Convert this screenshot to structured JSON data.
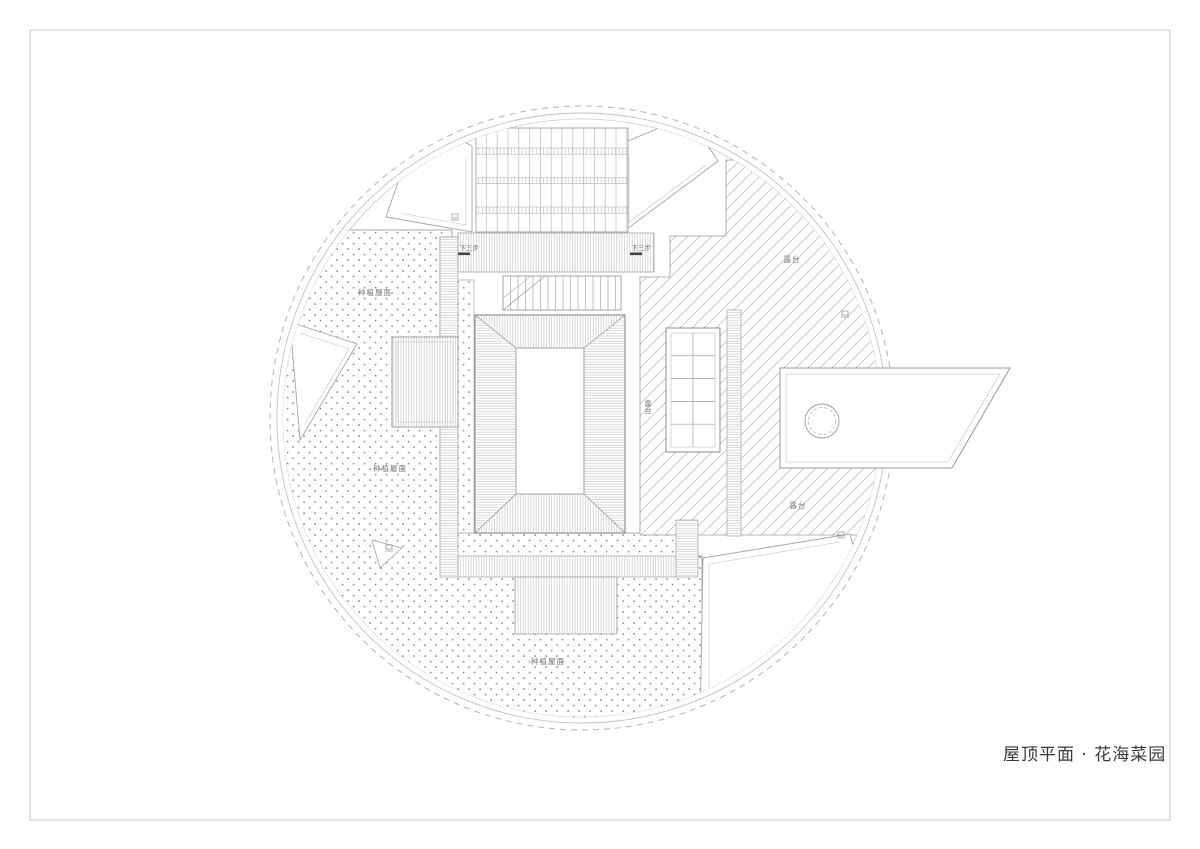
{
  "page": {
    "title_block": {
      "text": "屋顶平面 · 花海菜园"
    }
  },
  "plan": {
    "area_labels": [
      {
        "id": "planting-roof-upper-left",
        "text": "种植屋面"
      },
      {
        "id": "planting-roof-left",
        "text": "种植屋面"
      },
      {
        "id": "planting-roof-bottom",
        "text": "种植屋面"
      },
      {
        "id": "terrace-upper-right",
        "text": "露台"
      },
      {
        "id": "terrace-center-vertical",
        "text": "露台"
      },
      {
        "id": "terrace-lower-right",
        "text": "露台"
      }
    ],
    "stair_notes": [
      {
        "id": "stair-note-left",
        "text": "下三步"
      },
      {
        "id": "stair-note-right",
        "text": "下三步"
      }
    ]
  },
  "colors": {
    "linework": "#9a9a9a",
    "hatch": "#b8b8b8",
    "dots": "#8f8f8f",
    "label_text": "#787878",
    "title_text": "#3a3a3a",
    "background": "#ffffff"
  }
}
